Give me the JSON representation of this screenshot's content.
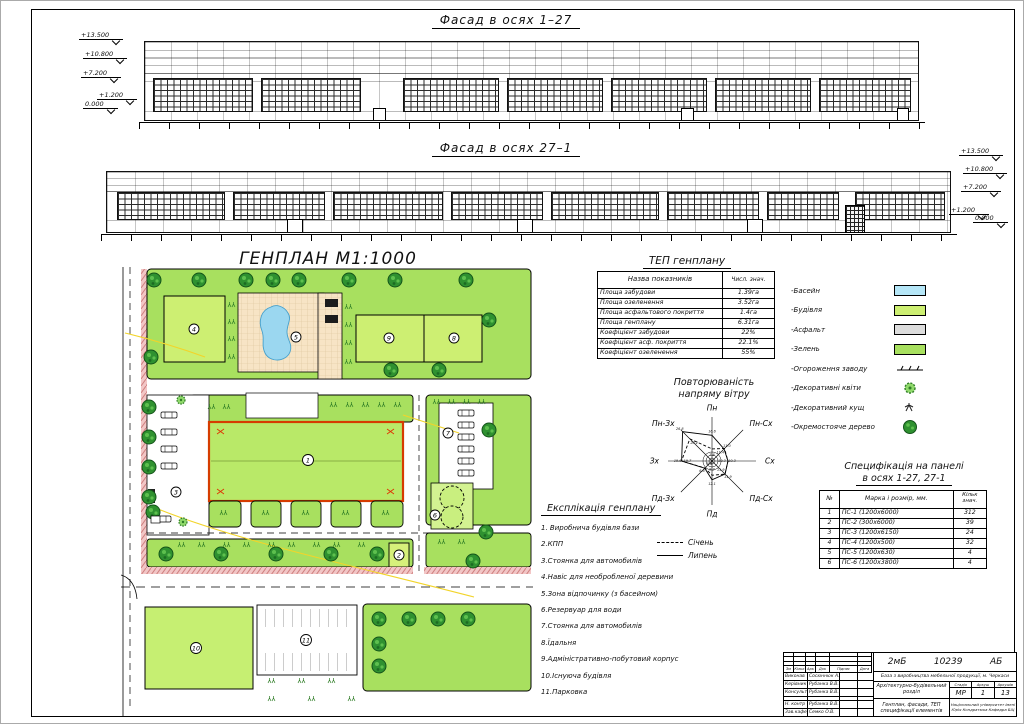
{
  "sheet": {
    "facade1_title": "Фасад в осях 1–27",
    "facade2_title": "Фасад в осях 27–1",
    "genplan_title": "ГЕНПЛАН М1:1000",
    "elevation_marks": [
      "+13.500",
      "+10.800",
      "+7.200",
      "+1.200",
      "0.000"
    ]
  },
  "tep_table": {
    "title": "ТЕП генплану",
    "col_name": "Назва показників",
    "col_value": "Числ. знач.",
    "rows": [
      [
        "Площа забудови",
        "1.39га"
      ],
      [
        "Площа озеленення",
        "3.52га"
      ],
      [
        "Площа асфальтового покриття",
        "1.4га"
      ],
      [
        "Площа генплану",
        "6.31га"
      ],
      [
        "Коефіцієнт забудови",
        "22%"
      ],
      [
        "Коефіцієнт асф. покриття",
        "22.1%"
      ],
      [
        "Коефіцієнт озеленення",
        "55%"
      ]
    ]
  },
  "legend": {
    "items": [
      {
        "label": "-Басейн",
        "type": "swatch",
        "color": "#b5e6f7"
      },
      {
        "label": "-Будівля",
        "type": "swatch",
        "color": "#cdef72"
      },
      {
        "label": "-Асфальт",
        "type": "swatch",
        "color": "#dcdcdc"
      },
      {
        "label": "-Зелень",
        "type": "swatch",
        "color": "#a8e05f"
      },
      {
        "label": "-Огороження заводу",
        "type": "fence"
      },
      {
        "label": "-Декоративні квіти",
        "type": "flower"
      },
      {
        "label": "-Декоративний кущ",
        "type": "bush"
      },
      {
        "label": "-Окремостояче дерево",
        "type": "tree"
      }
    ]
  },
  "chart_data": {
    "type": "radar",
    "title_line1": "Повторюваність",
    "title_line2": "напряму вітру",
    "directions": [
      "Пн",
      "Пн-Сх",
      "Сх",
      "Пд-Сх",
      "Пд",
      "Пд-Зх",
      "Зх",
      "Пн-Зх"
    ],
    "series": [
      {
        "name": "Січень",
        "style": "dashed",
        "values": [
          7.8,
          11.4,
          10.3,
          11.9,
          9.2,
          6.4,
          19.7,
          20.2
        ]
      },
      {
        "name": "Липень",
        "style": "solid",
        "values": [
          16.6,
          11.0,
          10.3,
          11.9,
          12.1,
          6.6,
          19.6,
          26.8
        ]
      }
    ],
    "legend": {
      "dashed": "Січень",
      "solid": "Липень"
    }
  },
  "spec_table": {
    "title_line1": "Специфікація на панелі",
    "title_line2": "в осях 1-27, 27-1",
    "col_num": "№",
    "col_mark": "Марка і розмір, мм.",
    "col_qty": "Кільк знач.",
    "rows": [
      [
        "1",
        "ПС-1   (1200х6000)",
        "312"
      ],
      [
        "2",
        "ПС-2   (300х6000)",
        "39"
      ],
      [
        "3",
        "ПС-3   (1200х6150)",
        "24"
      ],
      [
        "4",
        "ПС-4   (1200х500)",
        "32"
      ],
      [
        "5",
        "ПС-5   (1200х630)",
        "4"
      ],
      [
        "6",
        "ПС-6   (1200х3800)",
        "4"
      ]
    ]
  },
  "explication": {
    "title": "Експлікація генплану",
    "items": [
      "1. Виробнича будівля бази",
      "2.КПП",
      "3.Стоянка для автомобилів",
      "4.Навіс для необробленої деревини",
      "5.Зона відпочинку (з басейном)",
      "6.Резервуар для води",
      "7.Стоянка для автомобилів",
      "8.Їдальня",
      "9.Адміністративно-побутовий корпус",
      "10.Існуюча будівля",
      "11.Парковка"
    ]
  },
  "genplan": {
    "labels": [
      "1",
      "2",
      "3",
      "4",
      "5",
      "6",
      "7",
      "8",
      "9",
      "10",
      "11"
    ]
  },
  "title_block": {
    "code_left": "2мБ",
    "code_mid": "10239",
    "code_right": "АБ",
    "project": "База з виробництва мебельної продукції, м. Черкаси",
    "section": "Архітектурно-будівельний розділ",
    "stage_label": "Стадія",
    "sheet_label": "Аркуш",
    "sheets_label": "Аркушів",
    "stage": "МР",
    "sheet": "1",
    "sheets": "13",
    "content_line1": "Генплан, фасади, ТЕП",
    "content_line2": "специфікації елементів",
    "organization": "Національний університет імені Юрія Кондратюка Кафедра БіЦ",
    "header_cols": [
      "Зм",
      "Кільк",
      "Арк",
      "Док",
      "Підпис",
      "Дата"
    ],
    "people": [
      {
        "role": "Виконав",
        "name": "Сосюннюк А."
      },
      {
        "role": "Керівник",
        "name": "Рубанка В.В."
      },
      {
        "role": "Консульт",
        "name": "Рубанка В.В."
      },
      {
        "role": "",
        "name": ""
      },
      {
        "role": "Н. контр",
        "name": "Рубанка В.В."
      },
      {
        "role": "Зав.кафед",
        "name": "Семко О.В."
      }
    ]
  }
}
